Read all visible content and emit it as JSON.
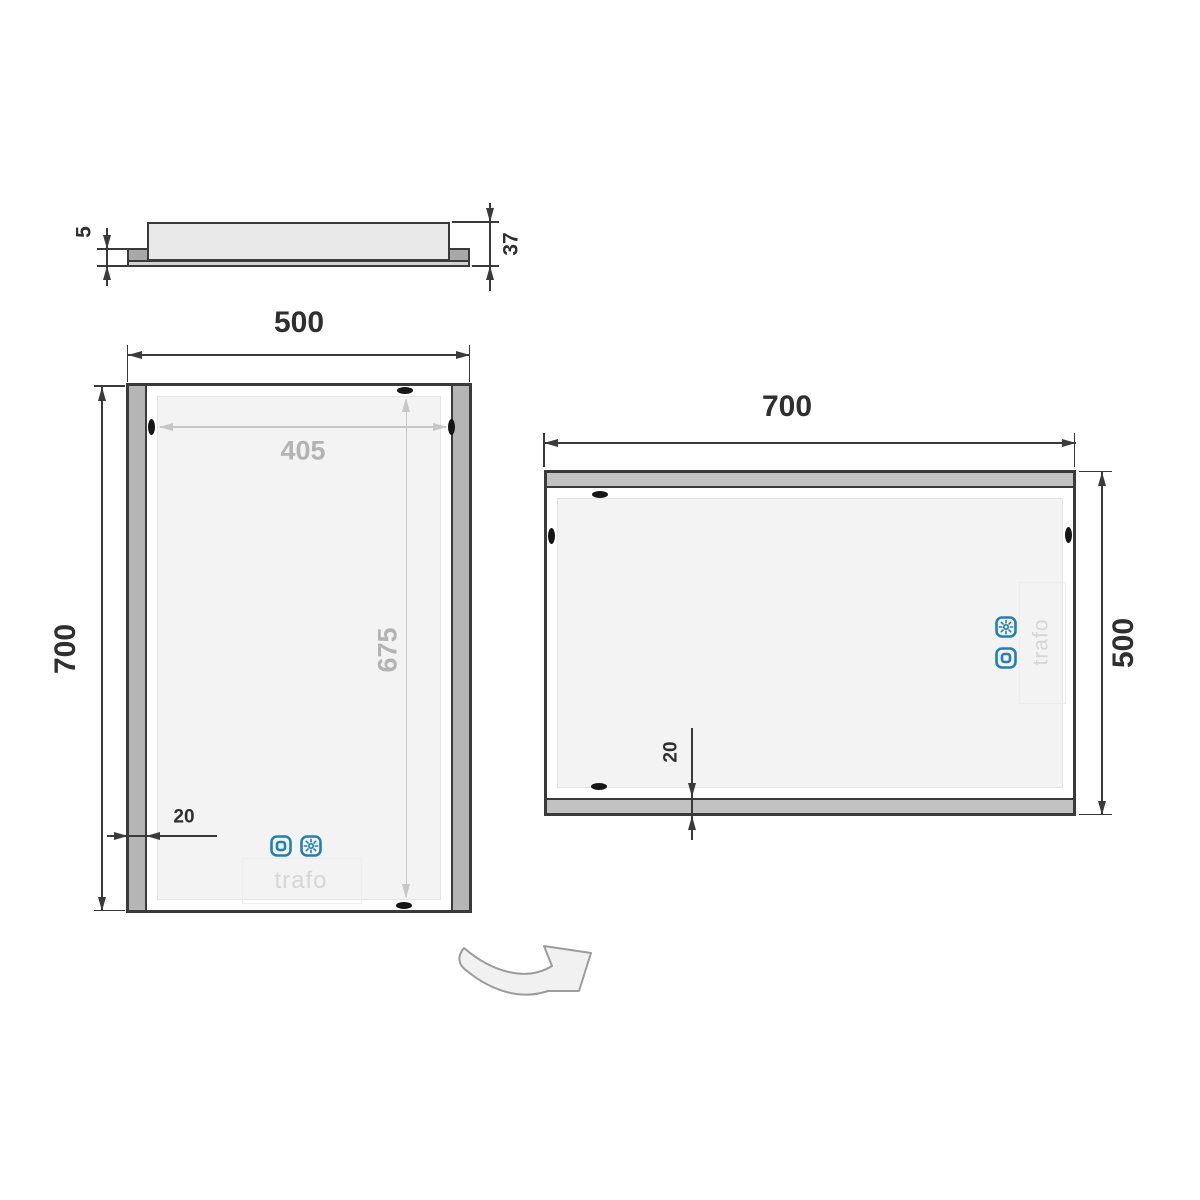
{
  "colors": {
    "line": "#3a3a3a",
    "gray_dimension": "#c7c7c7",
    "gray_dimension_text": "#b3b3b3",
    "accent_blue": "#2380b5",
    "trafo_text_color": "#d6d6d6",
    "led_strip_gray": "#b5b5b5"
  },
  "profile_view": {
    "front_thickness": "5",
    "total_depth": "37"
  },
  "portrait_view": {
    "width": "500",
    "height": "700",
    "illuminated_width": "405",
    "illuminated_height": "675",
    "strip_width": "20",
    "trafo_label": "trafo"
  },
  "landscape_view": {
    "width": "700",
    "height": "500",
    "strip_width": "20",
    "trafo_label": "trafo"
  },
  "icons": {
    "touch_switch": "touch-switch-icon",
    "brightness": "brightness-icon",
    "rotate": "rotate-arrow-icon"
  }
}
